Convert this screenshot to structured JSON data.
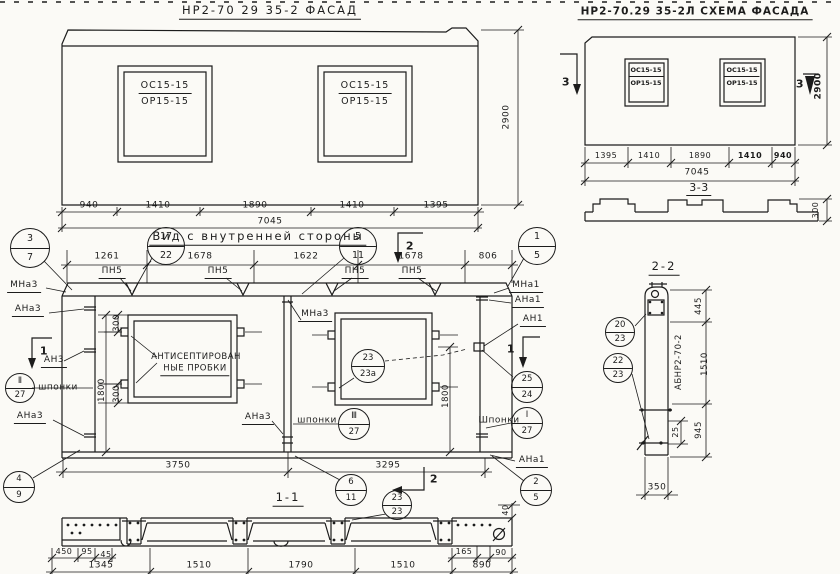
{
  "facade": {
    "title": "НР2-70 29 35-2    ФАСАД",
    "window1": {
      "line1": "ОС15-15",
      "line2": "ОР15-15"
    },
    "window2": {
      "line1": "ОС15-15",
      "line2": "ОР15-15"
    },
    "height_dim": "2900",
    "dims": [
      "940",
      "1410",
      "1890",
      "1410",
      "1395"
    ],
    "total_dim": "7045"
  },
  "scheme": {
    "title": "НР2-70.29 35-2Л  СХЕМА ФАСАДА",
    "window1": {
      "line1": "ОС15-15",
      "line2": "ОР15-15"
    },
    "window2": {
      "line1": "ОС15-15",
      "line2": "ОР15-15"
    },
    "height_dim": "2900",
    "marker_left": "3",
    "marker_right": "3",
    "dims": [
      "1395",
      "1410",
      "1890",
      "1410",
      "940"
    ],
    "total_dim": "7045",
    "section33": {
      "title": "3-3",
      "height_dim": "300"
    }
  },
  "interior": {
    "title": "Вид с внутренней стороны",
    "top_dims": [
      "1261",
      "1678",
      "1622",
      "1678",
      "806"
    ],
    "joint_labels": [
      "ПН5",
      "ПН5",
      "ПН5",
      "ПН5"
    ],
    "left_dims": {
      "d300a": "300",
      "d1800": "1800",
      "d300b": "300"
    },
    "right_dim": "1800",
    "bottom_dims": [
      "3750",
      "3295"
    ],
    "marker1": "1",
    "marker2": "2",
    "labels": {
      "mna3_top": "МНа3",
      "ana3_top": "АНа3",
      "an3": "АН3",
      "shponki_left": "шпонки",
      "ana3_mid": "АНа3",
      "mna3_center": "МНа3",
      "ana3_center": "АНа3",
      "shponki_center": "шпонки",
      "mna1": "МНа1",
      "ana1_top": "АНа1",
      "an1": "АН1",
      "shponki_right": "Шпонки",
      "ana1_bottom": "АНа1",
      "plugs_line1": "АНТИСЕПТИРОВАН",
      "plugs_line2": "НЫЕ ПРОБКИ"
    }
  },
  "section11": {
    "title": "1-1",
    "sub_dims_left": [
      "450",
      "95",
      "45"
    ],
    "sub_dims_right": [
      "165",
      "90"
    ],
    "main_dims": [
      "1345",
      "1510",
      "1790",
      "1510",
      "890"
    ],
    "top_dim": "40"
  },
  "section22": {
    "title": "2-2",
    "part_label": "АБНР2-70-2",
    "dims": [
      "445",
      "1510",
      "945"
    ],
    "small_dim": "25",
    "width_dim": "350"
  },
  "callouts": [
    {
      "top": "3",
      "bottom": "7"
    },
    {
      "top": "17",
      "bottom": "22"
    },
    {
      "top": "5",
      "bottom": "11"
    },
    {
      "top": "1",
      "bottom": "5"
    },
    {
      "top": "23",
      "bottom": "23а"
    },
    {
      "top": "25",
      "bottom": "24"
    },
    {
      "top": "Ⅱ",
      "bottom": "27"
    },
    {
      "top": "Ⅲ",
      "bottom": "27"
    },
    {
      "top": "Ⅰ",
      "bottom": "27"
    },
    {
      "top": "4",
      "bottom": "9"
    },
    {
      "top": "6",
      "bottom": "11"
    },
    {
      "top": "2",
      "bottom": "5"
    },
    {
      "top": "23",
      "bottom": "23"
    },
    {
      "top": "20",
      "bottom": "23"
    },
    {
      "top": "22",
      "bottom": "23"
    }
  ]
}
